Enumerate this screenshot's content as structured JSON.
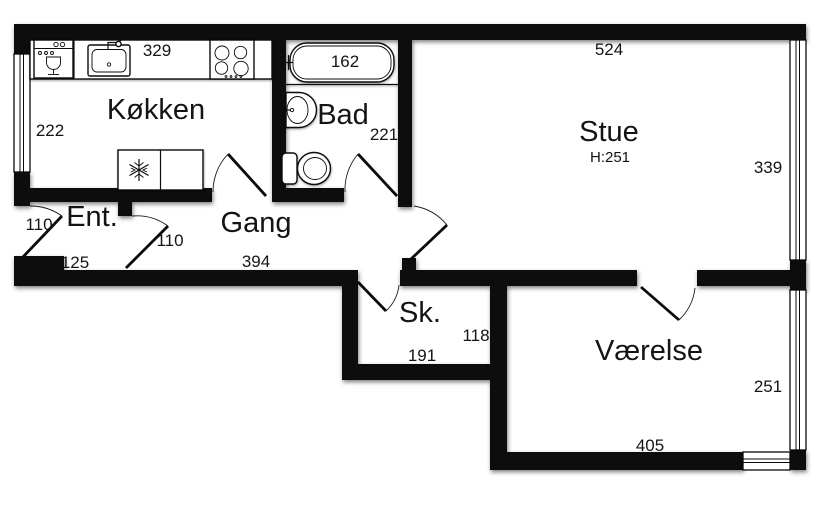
{
  "plan_type": "floor-plan",
  "colors": {
    "wall": "#0a0a0a",
    "background": "#ffffff",
    "text": "#141414"
  },
  "rooms": {
    "kokken": {
      "label": "Køkken",
      "dim_top": "329",
      "dim_left": "222"
    },
    "bad": {
      "label": "Bad",
      "dim_tub": "162",
      "dim_right": "221"
    },
    "stue": {
      "label": "Stue",
      "ceiling_height": "H:251",
      "dim_top": "524",
      "dim_right": "339"
    },
    "ent": {
      "label": "Ent.",
      "dim_door": "110",
      "dim_bottom": "125"
    },
    "gang": {
      "label": "Gang",
      "dim_door": "110",
      "dim_bottom": "394"
    },
    "sk": {
      "label": "Sk.",
      "dim_right": "118",
      "dim_bottom": "191"
    },
    "vaerelse": {
      "label": "Værelse",
      "dim_right": "251",
      "dim_bottom": "405"
    }
  },
  "icons": {
    "dishwasher": "dishwasher-icon",
    "sink": "sink-icon",
    "stove": "stove-icon",
    "fridge": "fridge-icon",
    "snowflake": "snowflake-icon",
    "bathtub": "bathtub-icon",
    "washbasin": "washbasin-icon",
    "toilet": "toilet-icon"
  }
}
